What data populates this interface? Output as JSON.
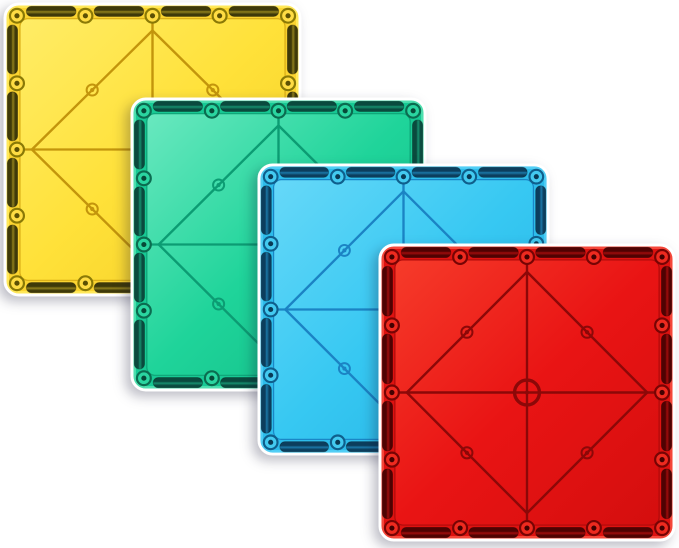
{
  "scene": {
    "type": "product-photo",
    "background_color": "#FFFFFF",
    "subject": "Four overlapping translucent square magnetic construction tiles arranged diagonally from top-left to bottom-right",
    "tile_count": 4
  },
  "tile_features": {
    "magnet_slots_per_edge": 4,
    "border_rivets_per_edge": 5,
    "inner_rivets": 4,
    "face_pattern": "vertical and horizontal midlines, inscribed diamond connecting midline points, center ring"
  },
  "tiles": [
    {
      "id": "yellow",
      "label": "yellow magnetic tile",
      "stack_order": 1,
      "position": {
        "left": 3,
        "top": 2,
        "width": 299,
        "height": 295
      },
      "colors": {
        "face_light": "#FFEC66",
        "face": "#FFE139",
        "face_dark": "#F3CC24",
        "ring_light": "#FFE85A",
        "ring": "#FBD430",
        "seam": "#D8AC15",
        "line": "#C3950C",
        "slot_dark": "#3E3909",
        "slot_light": "#8F7F1C",
        "rivet_edge": "#8A7906",
        "rivet_fill": "#FFDC43",
        "rivet_dot": "#5C5004"
      }
    },
    {
      "id": "green",
      "label": "green magnetic tile",
      "stack_order": 2,
      "position": {
        "left": 130,
        "top": 97,
        "width": 297,
        "height": 295
      },
      "colors": {
        "face_light": "#69E8BF",
        "face": "#1FD49A",
        "face_dark": "#10B984",
        "ring_light": "#4FDFAF",
        "ring": "#17C994",
        "seam": "#0FA377",
        "line": "#0C9C73",
        "slot_dark": "#0A4A3E",
        "slot_light": "#168F6E",
        "rivet_edge": "#0B6C50",
        "rivet_fill": "#2AD5A0",
        "rivet_dot": "#074A38"
      }
    },
    {
      "id": "blue",
      "label": "blue magnetic tile",
      "stack_order": 3,
      "position": {
        "left": 257,
        "top": 163,
        "width": 293,
        "height": 293
      },
      "colors": {
        "face_light": "#66D8F8",
        "face": "#37C8F2",
        "face_dark": "#22B1E2",
        "ring_light": "#52CEF5",
        "ring": "#2DBCEB",
        "seam": "#1A86C6",
        "line": "#1B83C4",
        "slot_dark": "#0C3E5D",
        "slot_light": "#1B77A7",
        "rivet_edge": "#0F5F8C",
        "rivet_fill": "#43CAF0",
        "rivet_dot": "#093A55"
      }
    },
    {
      "id": "red",
      "label": "red magnetic tile",
      "stack_order": 4,
      "position": {
        "left": 378,
        "top": 243,
        "width": 298,
        "height": 299
      },
      "colors": {
        "face_light": "#F63B2A",
        "face": "#E91414",
        "face_dark": "#D40E0E",
        "ring_light": "#F4473A",
        "ring": "#DE1210",
        "seam": "#AE0B0B",
        "line": "#8C0808",
        "slot_dark": "#4F0202",
        "slot_light": "#A00C0C",
        "rivet_edge": "#770404",
        "rivet_fill": "#EE2A1F",
        "rivet_dot": "#430101"
      }
    }
  ]
}
